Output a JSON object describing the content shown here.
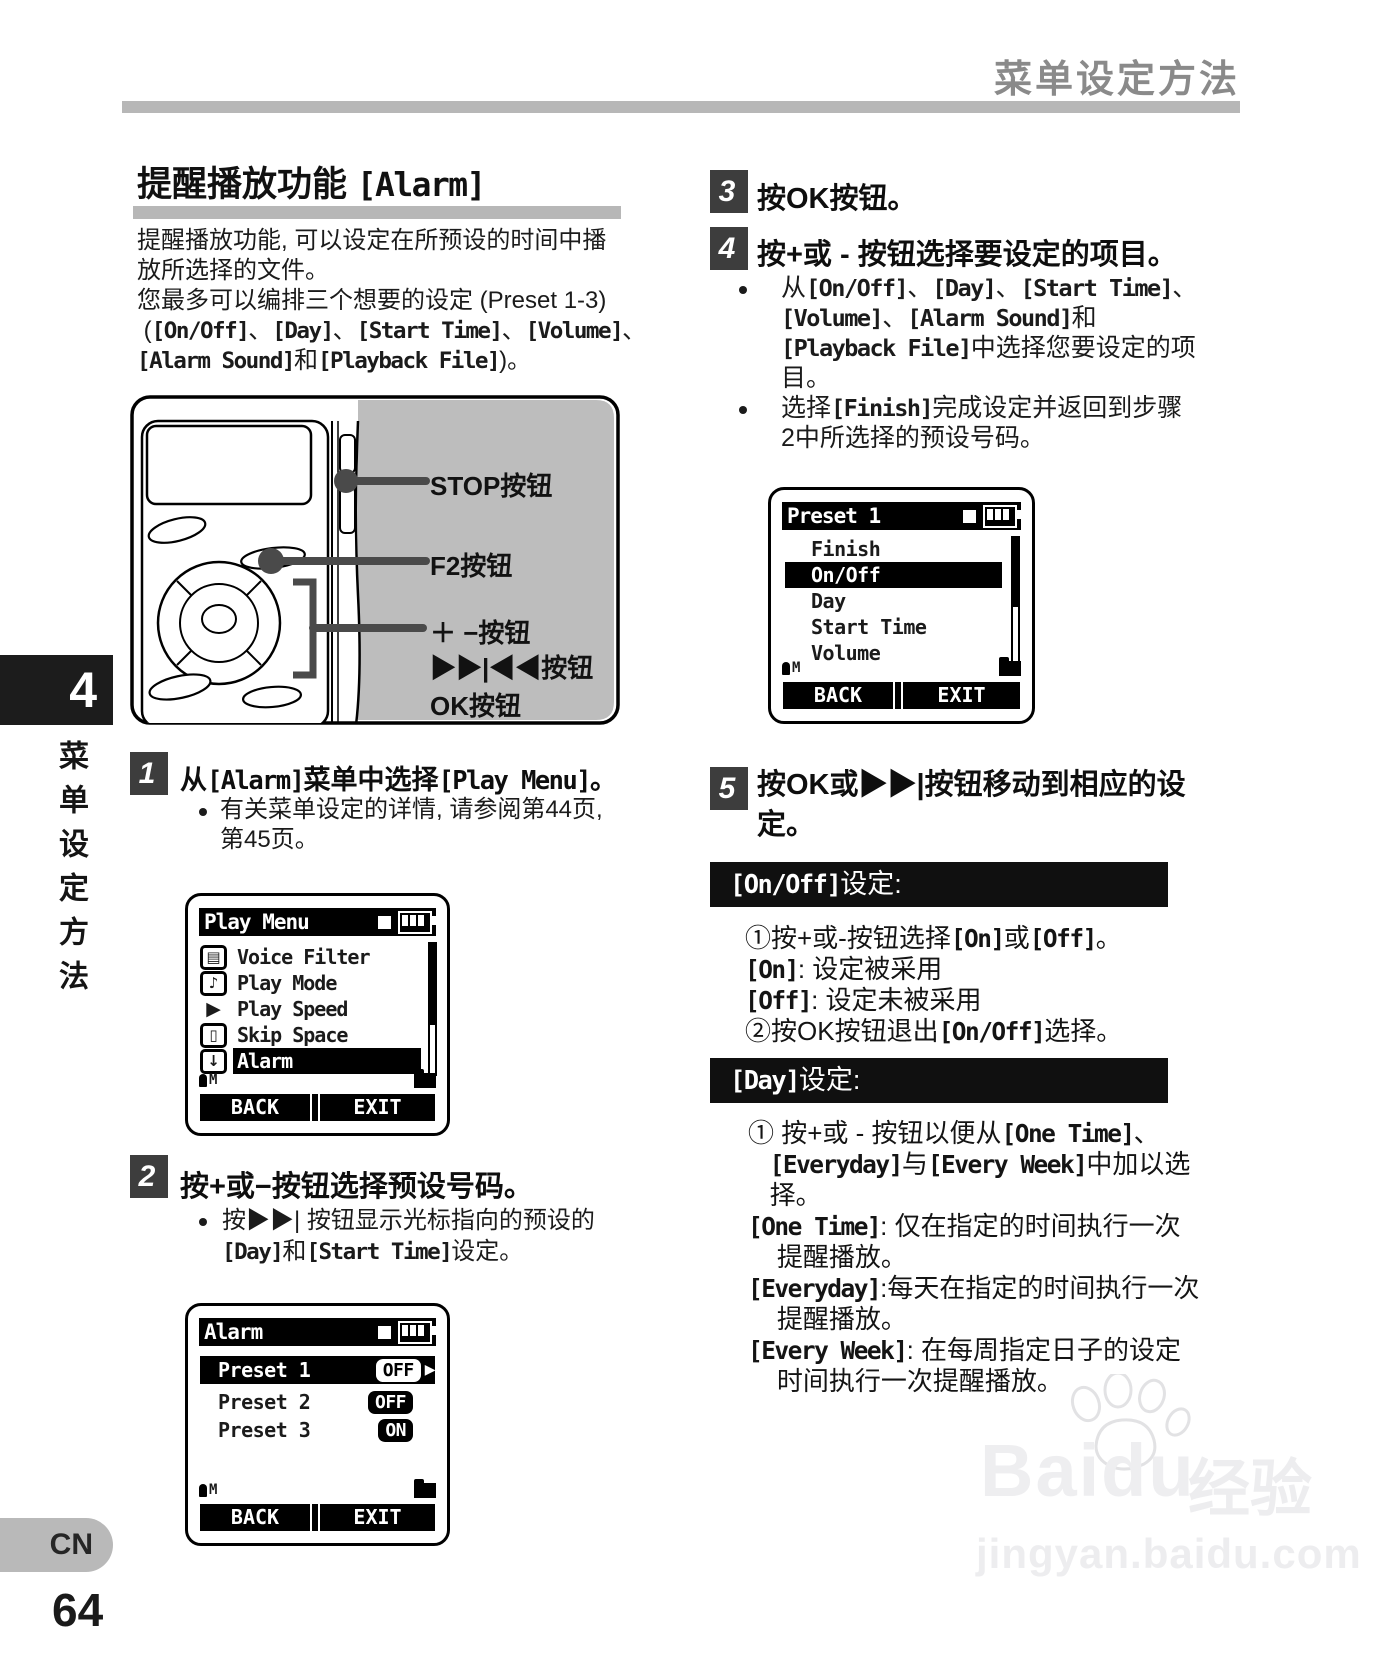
{
  "header": {
    "title": "菜单设定方法"
  },
  "sidebar": {
    "chapter": "4",
    "vertical_title": "菜单设定方法",
    "lang": "CN",
    "page_number": "64"
  },
  "glyphs": {
    "bullet": "•"
  },
  "left": {
    "title": "提醒播放功能 [Alarm]",
    "intro": [
      "提醒播放功能, 可以设定在所预设的时间中播",
      "放所选择的文件。",
      "您最多可以编排三个想要的设定 (Preset 1-3)",
      " ([On/Off]、[Day]、[Start Time]、[Volume]、",
      "[Alarm Sound]和[Playback File])。"
    ],
    "device_labels": [
      "STOP按钮",
      "F2按钮",
      "＋ −按钮",
      "▶▶|◀◀按钮",
      "OK按钮"
    ],
    "step1": {
      "num": "1",
      "heading": "从[Alarm]菜单中选择[Play Menu]。",
      "bullet_lines": [
        "有关菜单设定的详情, 请参阅第44页,",
        "第45页。"
      ]
    },
    "step2": {
      "num": "2",
      "heading": "按+或−按钮选择预设号码。",
      "bullet_lines": [
        "按▶▶| 按钮显示光标指向的预设的",
        "[Day]和[Start Time]设定。"
      ]
    }
  },
  "right": {
    "step3": {
      "num": "3",
      "heading": "按OK按钮。"
    },
    "step4": {
      "num": "4",
      "heading": "按+或 - 按钮选择要设定的项目。",
      "bullet1_lines": [
        "从[On/Off]、[Day]、[Start Time]、",
        "[Volume]、[Alarm Sound]和",
        "[Playback File]中选择您要设定的项",
        "目。"
      ],
      "bullet2_lines": [
        "选择[Finish]完成设定并返回到步骤",
        "2中所选择的预设号码。"
      ]
    },
    "step5": {
      "num": "5",
      "heading_lines": [
        "按OK或▶▶|按钮移动到相应的设",
        "定。"
      ]
    },
    "onoff": {
      "banner": "[On/Off]设定:",
      "lines": [
        "①按+或-按钮选择[On]或[Off]。",
        "[On]: 设定被采用",
        "[Off]: 设定未被采用",
        "②按OK按钮退出[On/Off]选择。"
      ]
    },
    "day": {
      "banner": "[Day]设定:",
      "lines": [
        "① 按+或 - 按钮以便从[One Time]、",
        "   [Everyday]与[Every Week]中加以选",
        "   择。",
        "[One Time]: 仅在指定的时间执行一次",
        "    提醒播放。",
        "[Everyday]:每天在指定的时间执行一次",
        "    提醒播放。",
        "[Every Week]: 在每周指定日子的设定",
        "    时间执行一次提醒播放。"
      ]
    }
  },
  "screens": {
    "play_menu": {
      "title": "Play Menu",
      "items": [
        {
          "icon": "document",
          "glyph": "▤",
          "label": "Voice Filter"
        },
        {
          "icon": "microphone",
          "glyph": "♪",
          "label": "Play Mode"
        },
        {
          "icon": "play",
          "glyph": "▶",
          "label": "Play Speed"
        },
        {
          "icon": "monitor",
          "glyph": "▯",
          "label": "Skip Space"
        },
        {
          "icon": "arrow-down",
          "glyph": "↓",
          "label": "Alarm"
        }
      ],
      "status_left": "M",
      "softkeys": {
        "back": "BACK",
        "exit": "EXIT"
      }
    },
    "alarm": {
      "title": "Alarm",
      "rows": [
        {
          "label": "Preset 1",
          "value": "OFF",
          "arrow": "▶"
        },
        {
          "label": "Preset 2",
          "value": "OFF"
        },
        {
          "label": "Preset 3",
          "value": "ON"
        }
      ],
      "status_left": "M",
      "softkeys": {
        "back": "BACK",
        "exit": "EXIT"
      }
    },
    "preset": {
      "title": "Preset 1",
      "items": [
        {
          "label": "Finish"
        },
        {
          "label": "On/Off"
        },
        {
          "label": "Day"
        },
        {
          "label": "Start Time"
        },
        {
          "label": "Volume"
        }
      ],
      "status_left": "M",
      "softkeys": {
        "back": "BACK",
        "exit": "EXIT"
      }
    }
  },
  "watermark": {
    "brand": "Baidu",
    "brand_cn": "经验",
    "url": "jingyan.baidu.com"
  }
}
